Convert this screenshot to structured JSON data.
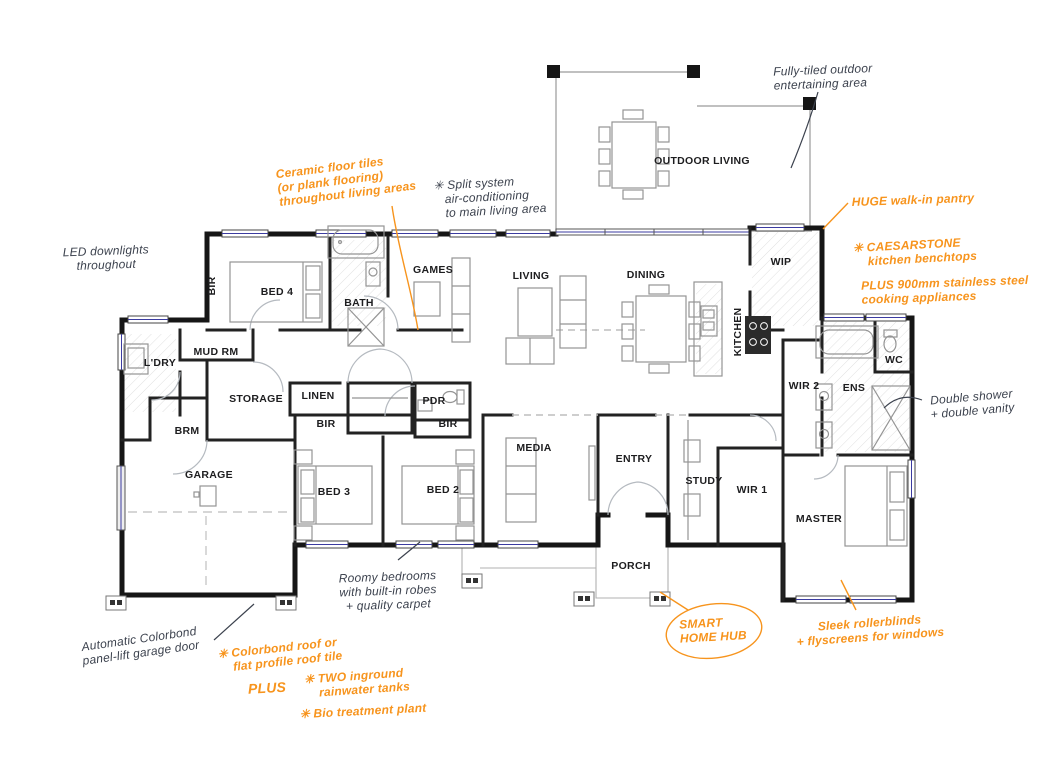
{
  "title": "Single storey house floor plan with feature annotations",
  "colors": {
    "accent_orange": "#F7941D",
    "ink_gray": "#3C424E",
    "wall_black": "#161616",
    "window_blue": "#3b3ba0",
    "furniture_gray": "#949494"
  },
  "room_labels": [
    {
      "id": "bir-top",
      "text": "BIR",
      "x": 212,
      "y": 286,
      "vertical": true
    },
    {
      "id": "bed4",
      "text": "BED 4",
      "x": 277,
      "y": 292
    },
    {
      "id": "bath",
      "text": "BATH",
      "x": 359,
      "y": 303
    },
    {
      "id": "games",
      "text": "GAMES",
      "x": 433,
      "y": 270
    },
    {
      "id": "living",
      "text": "LIVING",
      "x": 531,
      "y": 276
    },
    {
      "id": "dining",
      "text": "DINING",
      "x": 646,
      "y": 275
    },
    {
      "id": "outdoor-living",
      "text": "OUTDOOR LIVING",
      "x": 702,
      "y": 161
    },
    {
      "id": "wip",
      "text": "WIP",
      "x": 781,
      "y": 262
    },
    {
      "id": "kitchen",
      "text": "KITCHEN",
      "x": 738,
      "y": 332,
      "vertical": true
    },
    {
      "id": "mud-rm",
      "text": "MUD RM",
      "x": 216,
      "y": 352
    },
    {
      "id": "ldry",
      "text": "L'DRY",
      "x": 160,
      "y": 363
    },
    {
      "id": "storage",
      "text": "STORAGE",
      "x": 256,
      "y": 399
    },
    {
      "id": "linen",
      "text": "LINEN",
      "x": 318,
      "y": 396
    },
    {
      "id": "bir-linen",
      "text": "BIR",
      "x": 326,
      "y": 424
    },
    {
      "id": "pdr",
      "text": "PDR",
      "x": 434,
      "y": 401
    },
    {
      "id": "bir-pdr",
      "text": "BIR",
      "x": 448,
      "y": 424
    },
    {
      "id": "brm",
      "text": "BRM",
      "x": 187,
      "y": 431
    },
    {
      "id": "garage",
      "text": "GARAGE",
      "x": 209,
      "y": 475
    },
    {
      "id": "bed3",
      "text": "BED 3",
      "x": 334,
      "y": 492
    },
    {
      "id": "bed2",
      "text": "BED 2",
      "x": 443,
      "y": 490
    },
    {
      "id": "media",
      "text": "MEDIA",
      "x": 534,
      "y": 448
    },
    {
      "id": "entry",
      "text": "ENTRY",
      "x": 634,
      "y": 459
    },
    {
      "id": "study",
      "text": "STUDY",
      "x": 704,
      "y": 481
    },
    {
      "id": "wir1",
      "text": "WIR 1",
      "x": 752,
      "y": 490
    },
    {
      "id": "wir2",
      "text": "WIR 2",
      "x": 804,
      "y": 386
    },
    {
      "id": "ens",
      "text": "ENS",
      "x": 854,
      "y": 388
    },
    {
      "id": "wc",
      "text": "WC",
      "x": 894,
      "y": 360
    },
    {
      "id": "master",
      "text": "MASTER",
      "x": 819,
      "y": 519
    },
    {
      "id": "porch",
      "text": "PORCH",
      "x": 631,
      "y": 566
    }
  ],
  "annotations": [
    {
      "id": "fully-tiled",
      "text": "Fully-tiled outdoor\nentertaining area",
      "x": 823,
      "y": 77,
      "color": "gray",
      "rotate": -2
    },
    {
      "id": "led-downlights",
      "text": "LED downlights\nthroughout",
      "x": 106,
      "y": 258,
      "color": "gray",
      "rotate": -2,
      "align": "center"
    },
    {
      "id": "ceramic-tiles",
      "text": "Ceramic floor tiles\n(or plank flooring)\nthroughout living areas",
      "x": 346,
      "y": 180,
      "color": "orange",
      "rotate": -7
    },
    {
      "id": "split-system",
      "text": "✳ Split system\n   air-conditioning\n   to main living area",
      "x": 490,
      "y": 197,
      "color": "gray",
      "rotate": -3
    },
    {
      "id": "huge-pantry",
      "text": "HUGE walk-in pantry",
      "x": 913,
      "y": 200,
      "color": "orange",
      "rotate": -2
    },
    {
      "id": "caesarstone",
      "text": "✳ CAESARSTONE\n    kitchen benchtops",
      "x": 915,
      "y": 252,
      "color": "orange",
      "rotate": -3
    },
    {
      "id": "appliances",
      "text": "PLUS 900mm stainless steel\ncooking appliances",
      "x": 945,
      "y": 290,
      "color": "orange",
      "rotate": -2
    },
    {
      "id": "double-shower",
      "text": "Double shower\n+ double vanity",
      "x": 972,
      "y": 404,
      "color": "gray",
      "rotate": -5,
      "align": "center"
    },
    {
      "id": "roomy-bedrooms",
      "text": "Roomy bedrooms\nwith built-in robes\n+ quality carpet",
      "x": 388,
      "y": 591,
      "color": "gray",
      "rotate": -2,
      "align": "center"
    },
    {
      "id": "smart-home-hub",
      "text": "SMART\nHOME HUB",
      "x": 713,
      "y": 630,
      "color": "orange",
      "rotate": -3
    },
    {
      "id": "sleek-rollerblinds",
      "text": "Sleek rollerblinds\n+ flyscreens for windows",
      "x": 870,
      "y": 630,
      "color": "orange",
      "rotate": -4,
      "align": "center"
    },
    {
      "id": "auto-colorbond",
      "text": "Automatic Colorbond\npanel-lift garage door",
      "x": 140,
      "y": 646,
      "color": "gray",
      "rotate": -8,
      "align": "center"
    },
    {
      "id": "colorbond-roof",
      "text": "✳ Colorbond roof or\n    flat profile roof tile",
      "x": 280,
      "y": 655,
      "color": "orange",
      "rotate": -6
    },
    {
      "id": "plus-word",
      "text": "PLUS",
      "x": 267,
      "y": 688,
      "color": "orange",
      "rotate": -3,
      "size": 14
    },
    {
      "id": "rainwater-tanks",
      "text": "✳ TWO inground\n    rainwater tanks",
      "x": 357,
      "y": 683,
      "color": "orange",
      "rotate": -4
    },
    {
      "id": "bio-treatment",
      "text": "✳ Bio treatment plant",
      "x": 363,
      "y": 711,
      "color": "orange",
      "rotate": -3
    }
  ]
}
